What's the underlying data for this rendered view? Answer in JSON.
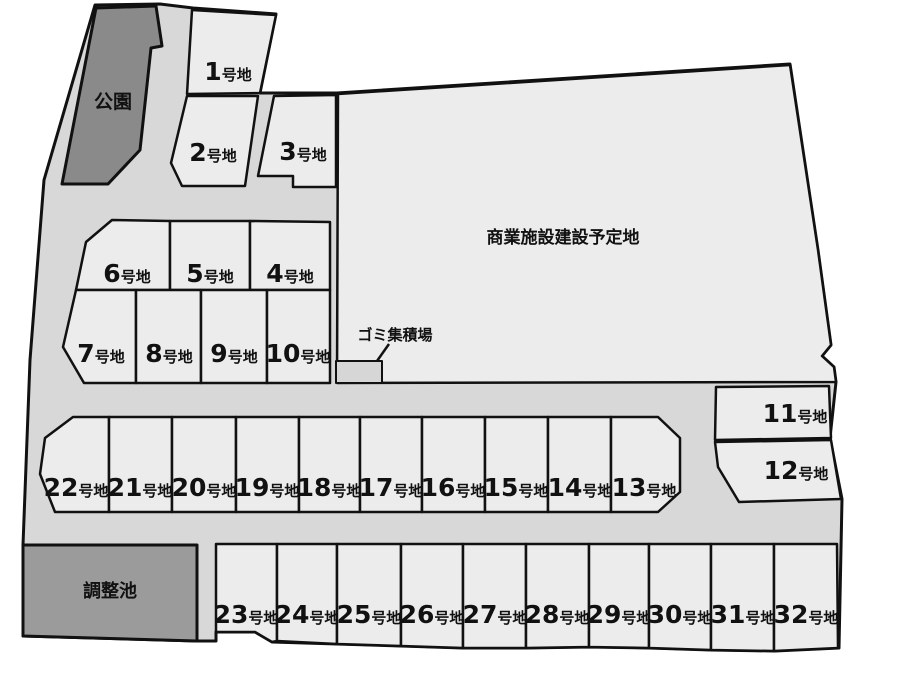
{
  "map": {
    "park": {
      "label": "公園"
    },
    "commercial": {
      "label": "商業施設建設予定地"
    },
    "garbage": {
      "label": "ゴミ集積場"
    },
    "pond": {
      "label": "調整池"
    },
    "lot_suffix": "号地",
    "lots": [
      {
        "number": "1"
      },
      {
        "number": "2"
      },
      {
        "number": "3"
      },
      {
        "number": "4"
      },
      {
        "number": "5"
      },
      {
        "number": "6"
      },
      {
        "number": "7"
      },
      {
        "number": "8"
      },
      {
        "number": "9"
      },
      {
        "number": "10"
      },
      {
        "number": "11"
      },
      {
        "number": "12"
      },
      {
        "number": "13"
      },
      {
        "number": "14"
      },
      {
        "number": "15"
      },
      {
        "number": "16"
      },
      {
        "number": "17"
      },
      {
        "number": "18"
      },
      {
        "number": "19"
      },
      {
        "number": "20"
      },
      {
        "number": "21"
      },
      {
        "number": "22"
      },
      {
        "number": "23"
      },
      {
        "number": "24"
      },
      {
        "number": "25"
      },
      {
        "number": "26"
      },
      {
        "number": "27"
      },
      {
        "number": "28"
      },
      {
        "number": "29"
      },
      {
        "number": "30"
      },
      {
        "number": "31"
      },
      {
        "number": "32"
      }
    ]
  },
  "colors": {
    "background": "#ffffff",
    "road": "#d8d8d8",
    "lot_fill": "#ececec",
    "park_fill": "#8a8a8a",
    "pond_fill": "#9b9b9b",
    "garbage_fill": "#d6d6d6",
    "line": "#111111"
  }
}
